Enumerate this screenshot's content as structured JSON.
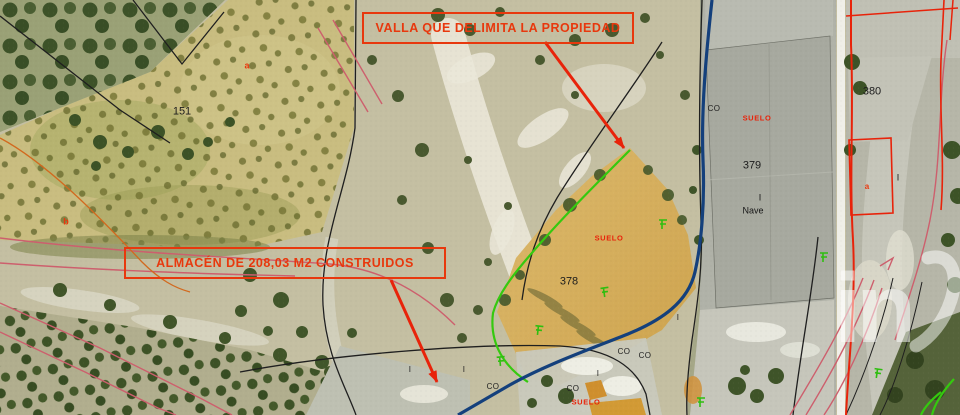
{
  "annotation_boxes": {
    "valla": "VALLA QUE DELIMITA LA PROPIEDAD",
    "almacen": "ALMACÉN DE 208,03 M2 CONSTRUIDOS"
  },
  "parcel_labels": {
    "p151": "151",
    "p378": "378",
    "p379": "379",
    "p380": "380",
    "nave": "Nave",
    "suelo": "SUELO",
    "co": "CO",
    "i": "I",
    "a": "a",
    "b": "b"
  },
  "watermark": "in",
  "colors": {
    "annotation_red": "#e8380d",
    "fence_green": "#35c90f",
    "property_blue": "#14407c",
    "road_pink": "#cd5f6d",
    "boundary_black": "#1f1f1f",
    "parcel_orange": "#d2691e"
  }
}
